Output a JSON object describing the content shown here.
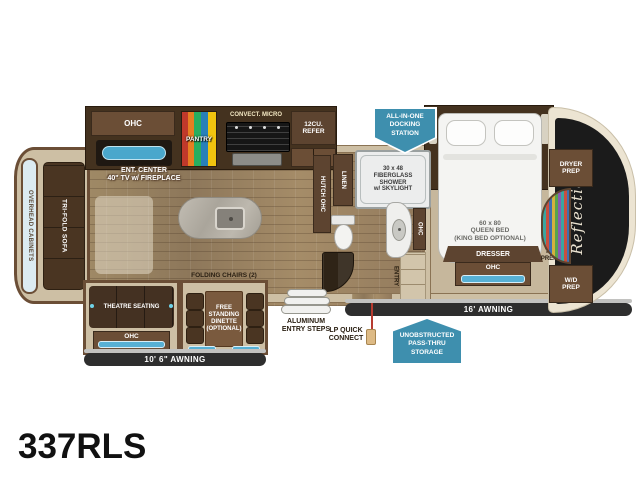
{
  "model": "337RLS",
  "front_cap": {
    "script": "Reflection",
    "dryer_prep": "DRYER\nPREP",
    "wd_prep": "W/D\nPREP"
  },
  "kitchen": {
    "ohc": "OHC",
    "pantry": "PANTRY",
    "convect_micro": "CONVECT. MICRO",
    "refer": "12CU.\nREFER",
    "ent_center": "ENT. CENTER\n40\" TV w/ FIREPLACE"
  },
  "rear": {
    "overhead_cabinets": "OVERHEAD CABINETS",
    "tri_fold_sofa": "TRI-FOLD SOFA"
  },
  "living": {
    "theatre_seating": "THEATRE SEATING",
    "theatre_ohc": "OHC",
    "folding_chairs": "FOLDING CHAIRS (2)",
    "dinette": "FREE\nSTANDING\nDINETTE\n(OPTIONAL)",
    "awning": "10' 6\" AWNING"
  },
  "bath": {
    "hutch_ohc": "HUTCH OHC",
    "linen": "LINEN",
    "shower": "30 x 48\nFIBERGLASS\nSHOWER\nw/ SKYLIGHT",
    "vanity_ohc": "OHC",
    "entry": "ENTRY"
  },
  "bedroom": {
    "bed": "60 x 80\nQUEEN BED\n(KING BED OPTIONAL)",
    "dresser": "DRESSER",
    "dresser_ohc": "OHC",
    "tv_prep": "TV\nPREP",
    "awning": "16' AWNING"
  },
  "exterior": {
    "docking_station": "ALL-IN-ONE\nDOCKING\nSTATION",
    "pass_thru_storage": "UNOBSTRUCTED\nPASS-THRU\nSTORAGE",
    "entry_steps": "ALUMINUM\nENTRY STEPS",
    "lp_quick_connect": "LP QUICK\nCONNECT"
  },
  "colors": {
    "badge_blue": "#3e8fae",
    "awning_dark": "#2e2e2e",
    "cabinet_brown": "#6b4e36",
    "wall_tan": "#cdbfa4",
    "window_blue": "#57b0d4",
    "front_cap_dark": "#1b1b1b"
  }
}
